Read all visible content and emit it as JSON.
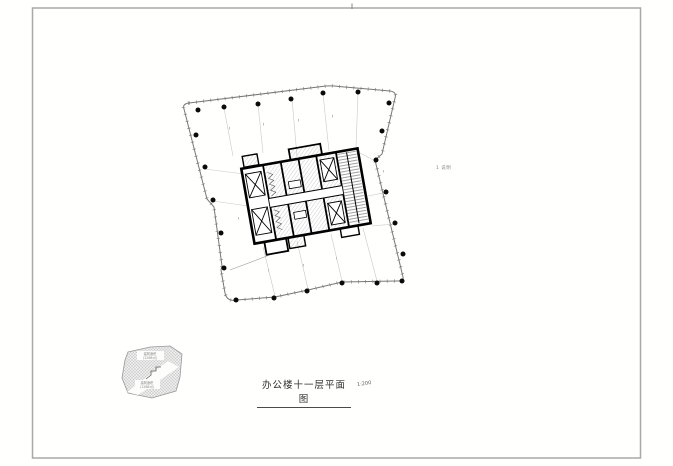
{
  "sheet": {
    "background": "#fffffe",
    "border_color": "#a8a8a8"
  },
  "drawing": {
    "title": "办公楼十一层平面图",
    "scale_note": "1:200",
    "plan_note": "1 说明",
    "keyplan": {
      "label_top_line1": "建筑面积",
      "label_top_line2": "(2268㎡)",
      "label_bottom_line1": "建筑面积",
      "label_bottom_line2": "(1268㎡)"
    },
    "colors": {
      "facade_outline": "#777777",
      "column_dot": "#0a0a0a",
      "core_wall": "#000000",
      "bay_line": "#c9c9c9",
      "hatch": "#9a9a9a",
      "keyplan_fill": "#ececec"
    }
  }
}
